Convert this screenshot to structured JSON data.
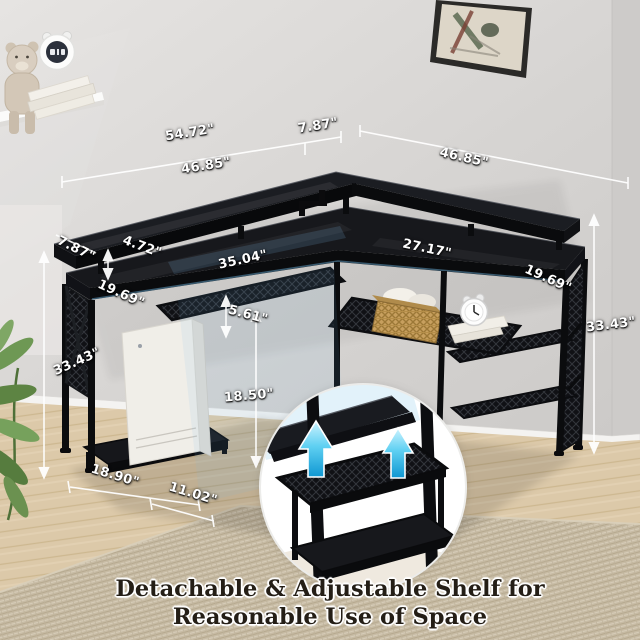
{
  "caption": {
    "line1": "Detachable & Adjustable Shelf for",
    "line2": "Reasonable Use of Space"
  },
  "dimensions": {
    "total_length_left": "54.72\"",
    "corner_overhang": "7.87\"",
    "shelf_length_left": "46.85\"",
    "shelf_length_right": "46.85\"",
    "riser_depth": "7.87\"",
    "riser_height": "4.72\"",
    "desktop_length_left": "35.04\"",
    "wing_depth_left": "19.69\"",
    "shelf_gap_height": "5.61\"",
    "desktop_length_right": "27.17\"",
    "wing_depth_right": "19.69\"",
    "overall_height_left": "33.43\"",
    "overall_height_right": "33.43\"",
    "under_desk_clearance": "18.50\"",
    "stand_length": "18.90\"",
    "stand_depth": "11.02\""
  },
  "colors": {
    "desk_black": "#131418",
    "accent_arrow_cyan": "#1fa9e0",
    "dimension_text": "#ffffff",
    "caption_text": "#241e16",
    "rug_beige": "#c8bca5",
    "wall_gray": "#d6d4d2"
  },
  "icons": {
    "adjustable_shelf_arrows": "up-arrow"
  }
}
